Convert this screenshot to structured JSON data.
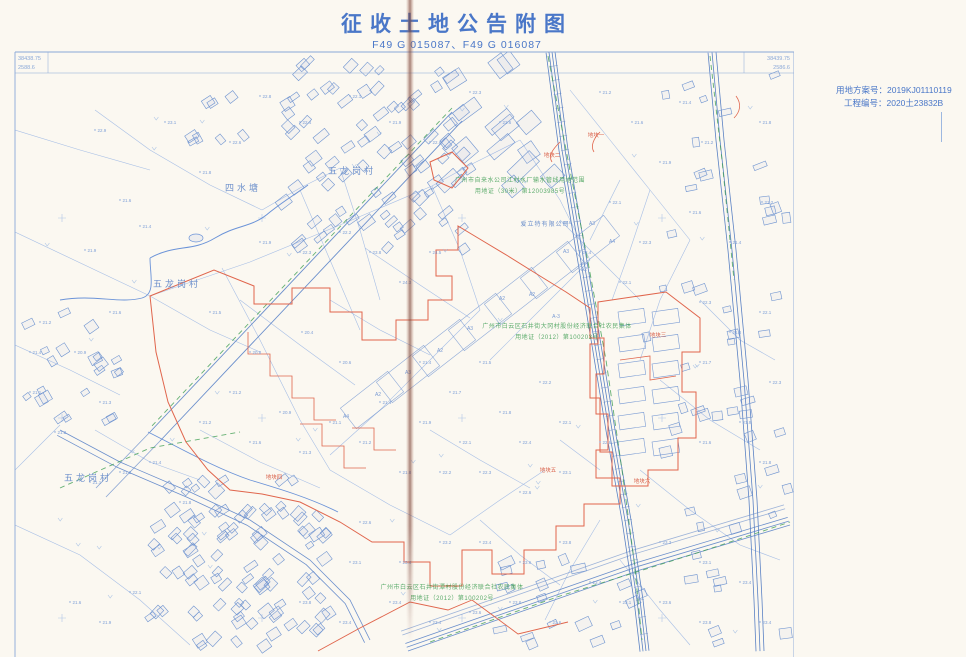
{
  "page": {
    "title": "征收土地公告附图",
    "subtitle": "F49 G 015087、F49 G 016087"
  },
  "info_panel": {
    "plan_number": "用地方案号：2019KJ01110119",
    "project_number": "工程编号：2020土23832B"
  },
  "map": {
    "corner_coords": {
      "top_left": [
        "38438.75",
        "2588.6"
      ],
      "top_right": [
        "38439.75",
        "2586.6"
      ]
    },
    "village_labels": [
      {
        "text": "五龙岗村",
        "x": 352,
        "y": 174
      },
      {
        "text": "四水塘",
        "x": 243,
        "y": 191
      },
      {
        "text": "五龙岗村",
        "x": 177,
        "y": 287
      },
      {
        "text": "五龙岗村",
        "x": 88,
        "y": 481
      }
    ],
    "company_labels": [
      {
        "text": "爱立特有限公司",
        "x": 545,
        "y": 226
      }
    ],
    "green_annotations": [
      {
        "x": 520,
        "y": 182,
        "lines": [
          "广州市自来水公司江村水厂输水管线用地范围",
          "用地证（30米）第12003985号"
        ]
      },
      {
        "x": 557,
        "y": 328,
        "lines": [
          "广州市白云区石井街大冈村股份经济联合社农民集体",
          "用地证（2012）第100203号"
        ]
      },
      {
        "x": 452,
        "y": 589,
        "lines": [
          "广州市白云区石井街潭村股份经济联合社农民集体",
          "用地证（2012）第100202号"
        ]
      }
    ],
    "plot_labels": [
      {
        "text": "地块一",
        "x": 596,
        "y": 137
      },
      {
        "text": "地块二",
        "x": 552,
        "y": 157
      },
      {
        "text": "地块三",
        "x": 658,
        "y": 337
      },
      {
        "text": "地块四",
        "x": 274,
        "y": 479
      },
      {
        "text": "地块五",
        "x": 548,
        "y": 472
      },
      {
        "text": "地块六",
        "x": 642,
        "y": 483
      }
    ],
    "building_labels": [
      {
        "text": "A3",
        "x": 592,
        "y": 225
      },
      {
        "text": "A4",
        "x": 612,
        "y": 243
      },
      {
        "text": "A3",
        "x": 566,
        "y": 253
      },
      {
        "text": "A2",
        "x": 584,
        "y": 271
      },
      {
        "text": "A2",
        "x": 532,
        "y": 296
      },
      {
        "text": "A-3",
        "x": 556,
        "y": 318
      },
      {
        "text": "A2",
        "x": 502,
        "y": 300
      },
      {
        "text": "A3",
        "x": 470,
        "y": 330
      },
      {
        "text": "A2",
        "x": 440,
        "y": 352
      },
      {
        "text": "A3",
        "x": 408,
        "y": 374
      },
      {
        "text": "A2",
        "x": 378,
        "y": 396
      },
      {
        "text": "A4",
        "x": 346,
        "y": 418
      }
    ],
    "spot_elevations": [
      [
        95,
        130,
        "22.9"
      ],
      [
        165,
        122,
        "23.1"
      ],
      [
        230,
        142,
        "22.6"
      ],
      [
        200,
        172,
        "21.8"
      ],
      [
        120,
        200,
        "21.6"
      ],
      [
        85,
        250,
        "21.9"
      ],
      [
        140,
        226,
        "21.4"
      ],
      [
        300,
        122,
        "22.4"
      ],
      [
        350,
        96,
        "22.1"
      ],
      [
        260,
        96,
        "22.8"
      ],
      [
        470,
        92,
        "22.3"
      ],
      [
        500,
        122,
        "22.6"
      ],
      [
        430,
        142,
        "22.1"
      ],
      [
        390,
        122,
        "21.9"
      ],
      [
        600,
        92,
        "21.2"
      ],
      [
        632,
        122,
        "21.6"
      ],
      [
        680,
        102,
        "21.4"
      ],
      [
        702,
        142,
        "21.2"
      ],
      [
        760,
        122,
        "21.8"
      ],
      [
        660,
        162,
        "21.9"
      ],
      [
        610,
        202,
        "22.1"
      ],
      [
        690,
        212,
        "21.6"
      ],
      [
        730,
        242,
        "21.4"
      ],
      [
        762,
        202,
        "21.2"
      ],
      [
        40,
        322,
        "21.2"
      ],
      [
        75,
        352,
        "20.9"
      ],
      [
        30,
        392,
        "21.1"
      ],
      [
        100,
        402,
        "21.3"
      ],
      [
        55,
        432,
        "21.2"
      ],
      [
        30,
        352,
        "21.4"
      ],
      [
        110,
        312,
        "21.6"
      ],
      [
        210,
        312,
        "21.5"
      ],
      [
        250,
        352,
        "20.8"
      ],
      [
        302,
        332,
        "20.4"
      ],
      [
        340,
        362,
        "20.6"
      ],
      [
        230,
        392,
        "21.2"
      ],
      [
        280,
        412,
        "20.9"
      ],
      [
        330,
        422,
        "21.1"
      ],
      [
        380,
        402,
        "21.4"
      ],
      [
        360,
        442,
        "21.2"
      ],
      [
        300,
        452,
        "21.3"
      ],
      [
        250,
        442,
        "21.6"
      ],
      [
        200,
        422,
        "21.2"
      ],
      [
        420,
        362,
        "21.4"
      ],
      [
        450,
        392,
        "21.7"
      ],
      [
        480,
        362,
        "21.5"
      ],
      [
        420,
        422,
        "21.9"
      ],
      [
        460,
        442,
        "22.1"
      ],
      [
        500,
        412,
        "21.8"
      ],
      [
        540,
        382,
        "22.2"
      ],
      [
        520,
        442,
        "22.4"
      ],
      [
        560,
        422,
        "22.1"
      ],
      [
        480,
        472,
        "22.3"
      ],
      [
        520,
        492,
        "22.6"
      ],
      [
        560,
        472,
        "23.1"
      ],
      [
        600,
        442,
        "22.8"
      ],
      [
        440,
        472,
        "22.2"
      ],
      [
        400,
        472,
        "21.8"
      ],
      [
        430,
        252,
        "24.5"
      ],
      [
        400,
        282,
        "24.3"
      ],
      [
        370,
        252,
        "23.8"
      ],
      [
        340,
        232,
        "22.2"
      ],
      [
        300,
        252,
        "22.3"
      ],
      [
        260,
        242,
        "21.9"
      ],
      [
        580,
        252,
        "22.4"
      ],
      [
        620,
        282,
        "22.1"
      ],
      [
        560,
        222,
        "23.6"
      ],
      [
        640,
        242,
        "22.3"
      ],
      [
        700,
        302,
        "22.3"
      ],
      [
        730,
        332,
        "21.8"
      ],
      [
        760,
        312,
        "22.1"
      ],
      [
        700,
        362,
        "21.7"
      ],
      [
        740,
        422,
        "21.9"
      ],
      [
        770,
        382,
        "22.3"
      ],
      [
        700,
        442,
        "21.6"
      ],
      [
        760,
        462,
        "21.8"
      ],
      [
        360,
        522,
        "22.6"
      ],
      [
        400,
        562,
        "23.4"
      ],
      [
        440,
        542,
        "23.2"
      ],
      [
        480,
        542,
        "23.4"
      ],
      [
        520,
        562,
        "23.6"
      ],
      [
        560,
        542,
        "23.8"
      ],
      [
        350,
        562,
        "23.1"
      ],
      [
        390,
        602,
        "23.4"
      ],
      [
        430,
        622,
        "23.4"
      ],
      [
        470,
        612,
        "23.6"
      ],
      [
        510,
        602,
        "23.8"
      ],
      [
        550,
        622,
        "23.6"
      ],
      [
        590,
        582,
        "23.4"
      ],
      [
        620,
        602,
        "23.1"
      ],
      [
        340,
        622,
        "23.4"
      ],
      [
        300,
        602,
        "23.8"
      ],
      [
        150,
        462,
        "21.4"
      ],
      [
        120,
        472,
        "21.2"
      ],
      [
        180,
        502,
        "21.8"
      ],
      [
        90,
        482,
        "21.1"
      ],
      [
        660,
        542,
        "23.3"
      ],
      [
        700,
        562,
        "23.1"
      ],
      [
        740,
        582,
        "23.4"
      ],
      [
        660,
        602,
        "23.6"
      ],
      [
        700,
        622,
        "23.8"
      ],
      [
        760,
        622,
        "23.4"
      ],
      [
        130,
        592,
        "22.1"
      ],
      [
        100,
        622,
        "21.9"
      ],
      [
        70,
        602,
        "21.6"
      ]
    ]
  },
  "colors": {
    "title_blue": "#4a77c8",
    "line_blue": "#9db8e4",
    "road_blue": "#6b8fcc",
    "railway_blue": "#5b82c4",
    "boundary_red": "#e0654c",
    "annotation_green": "#3f9e53",
    "crease_brown": "#8a5244",
    "paper": "#fbf8f1"
  }
}
